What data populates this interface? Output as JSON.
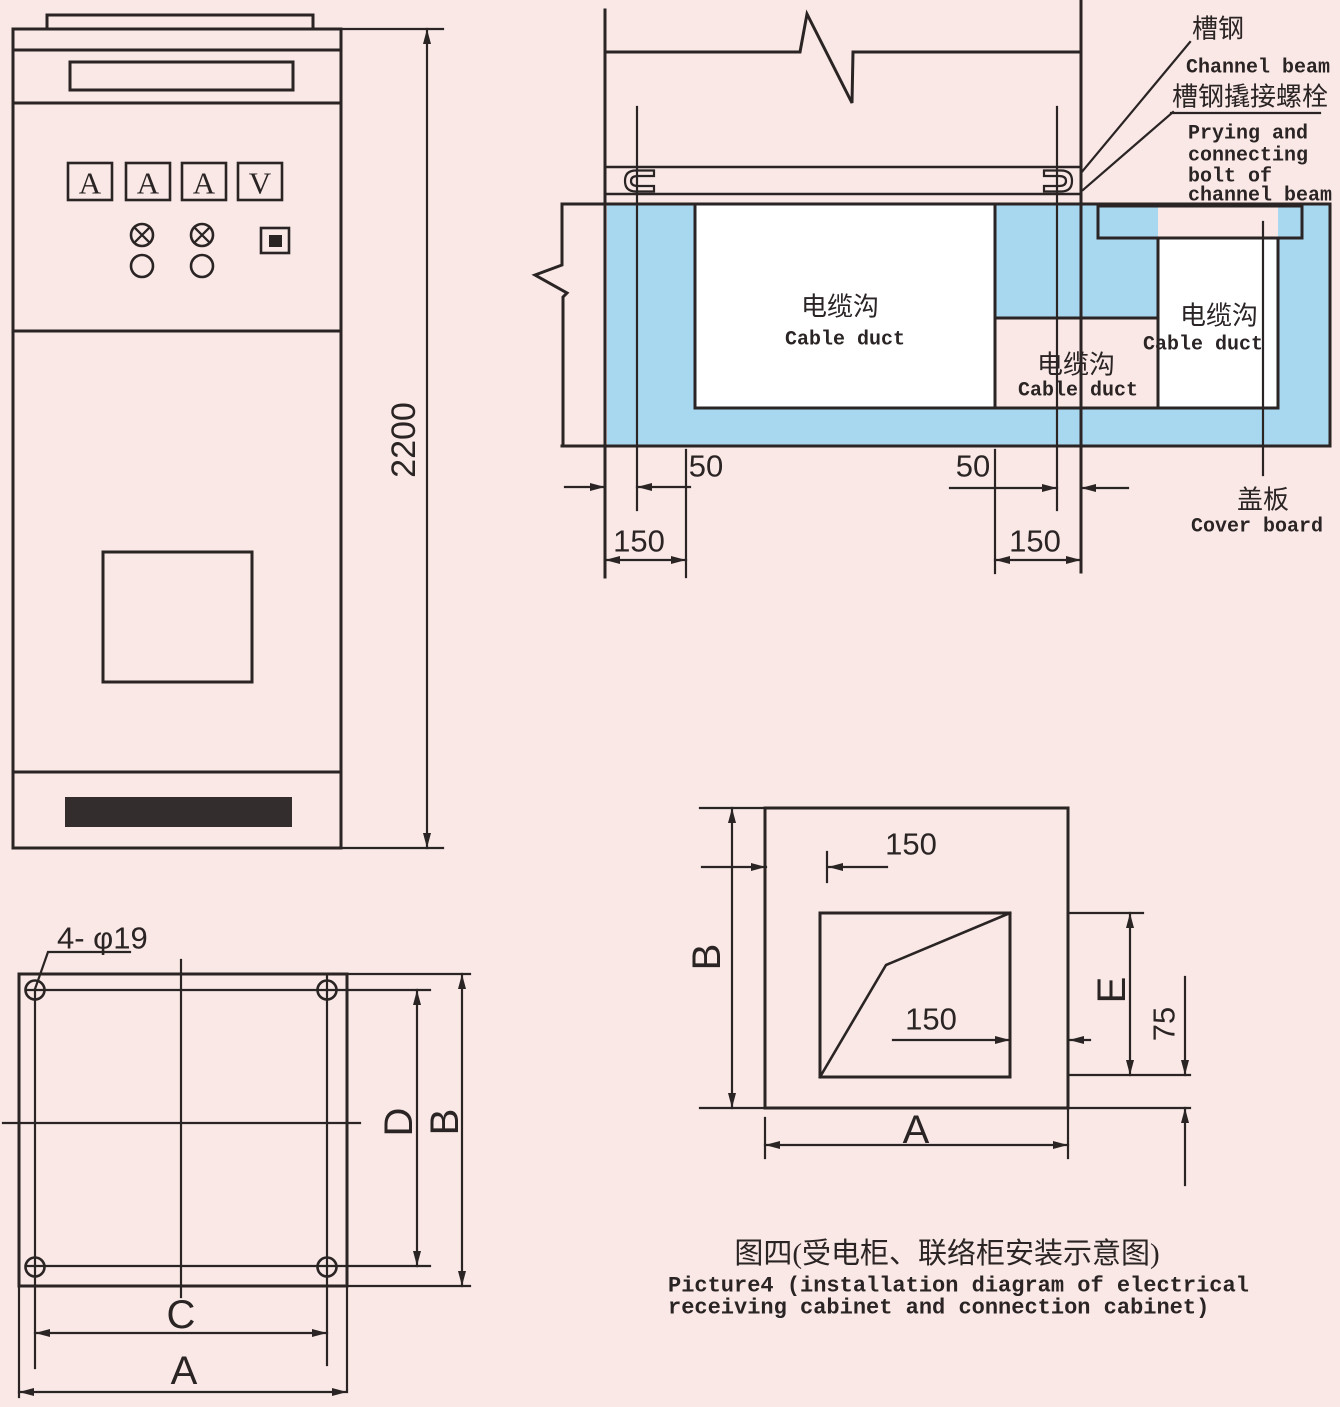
{
  "colors": {
    "background": "#f9e8e6",
    "line": "#2a2424",
    "duct_blue": "#a8d8f0",
    "cover_yellow": "#f2ea07",
    "duct_white": "#ffffff"
  },
  "front_view": {
    "height_dim": "2200",
    "meters": [
      "A",
      "A",
      "A",
      "V"
    ]
  },
  "section_view": {
    "channel_beam_cn": "槽钢",
    "channel_beam_en": "Channel beam",
    "bolt_label_cn": "槽钢撬接螺栓",
    "bolt_label_en": [
      "Prying and",
      "connecting",
      "bolt of",
      "channel beam"
    ],
    "cable_duct_cn": "电缆沟",
    "cable_duct_en": "Cable duct",
    "cover_board_cn": "盖板",
    "cover_board_en": "Cover board",
    "dim_50": "50",
    "dim_150": "150"
  },
  "plan_view": {
    "hole_label": "4- φ19",
    "dim_a": "A",
    "dim_b": "B",
    "dim_c": "C",
    "dim_d": "D"
  },
  "install_view": {
    "dim_150": "150",
    "dim_75": "75",
    "dim_a": "A",
    "dim_b": "B",
    "dim_e": "E"
  },
  "caption": {
    "cn": "图四(受电柜、联络柜安装示意图)",
    "en_line1": "Picture4 (installation diagram of electrical",
    "en_line2": "receiving cabinet and connection cabinet)"
  }
}
